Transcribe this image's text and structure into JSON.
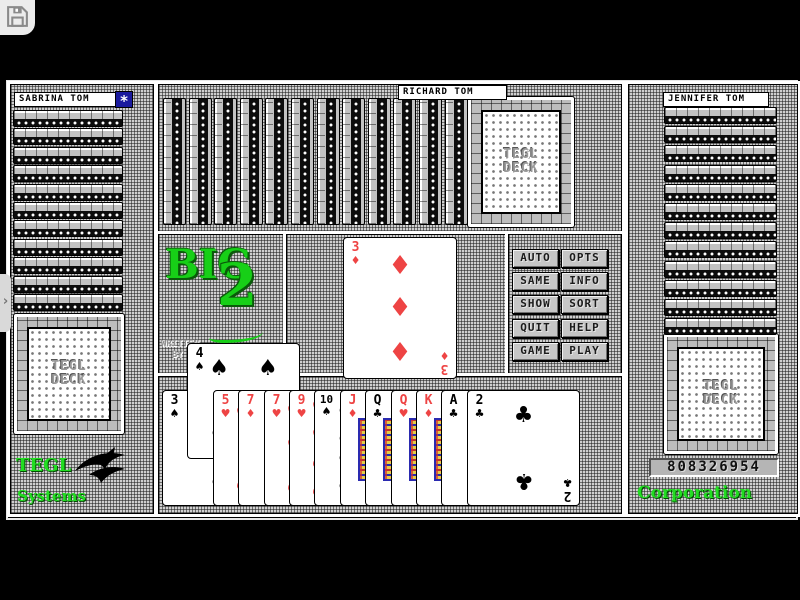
{
  "icons": {
    "save": "floppy-disk-icon",
    "window_gadget": "star-gadget-icon",
    "side_tab": "chevron-right-icon",
    "company_logo": "bird-logo-icon"
  },
  "players": {
    "left": {
      "name": "SABRINA TOM",
      "card_strips": 11,
      "card_backs": 1
    },
    "top": {
      "name": "RICHARD TOM",
      "card_strips": 12,
      "card_backs": 1
    },
    "right": {
      "name": "JENNIFER TOM",
      "card_strips": 12,
      "card_backs": 1
    }
  },
  "card_back": {
    "line1": "TEGL",
    "line2": "DECK"
  },
  "logo_panel": {
    "word": "BIG",
    "number": "2",
    "written_by_line1": "WRITTEN",
    "written_by_line2": "BY"
  },
  "played_card": {
    "rank": "3",
    "suit": "diamond"
  },
  "menu_buttons": [
    "AUTO",
    "OPTS",
    "SAME",
    "INFO",
    "SHOW",
    "SORT",
    "QUIT",
    "HELP",
    "GAME",
    "PLAY"
  ],
  "hand": {
    "cards": [
      {
        "rank": "3",
        "suit": "spade",
        "raised": false
      },
      {
        "rank": "4",
        "suit": "spade",
        "raised": true
      },
      {
        "rank": "5",
        "suit": "heart",
        "raised": false
      },
      {
        "rank": "7",
        "suit": "diamond",
        "raised": false
      },
      {
        "rank": "7",
        "suit": "heart",
        "raised": false
      },
      {
        "rank": "9",
        "suit": "heart",
        "raised": false
      },
      {
        "rank": "10",
        "suit": "spade",
        "raised": false
      },
      {
        "rank": "J",
        "suit": "diamond",
        "raised": false
      },
      {
        "rank": "Q",
        "suit": "club",
        "raised": false
      },
      {
        "rank": "Q",
        "suit": "heart",
        "raised": false
      },
      {
        "rank": "K",
        "suit": "diamond",
        "raised": false
      },
      {
        "rank": "A",
        "suit": "club",
        "raised": false
      },
      {
        "rank": "2",
        "suit": "club",
        "raised": false
      }
    ]
  },
  "branding": {
    "left_line1": "TEGL",
    "left_line2": "Systems",
    "right_serial": "808326954",
    "right_line": "Corporation"
  },
  "colors": {
    "suit_red": "#ee4444",
    "logo_green": "#17cf17",
    "gadget_blue": "#1a1a9e"
  }
}
